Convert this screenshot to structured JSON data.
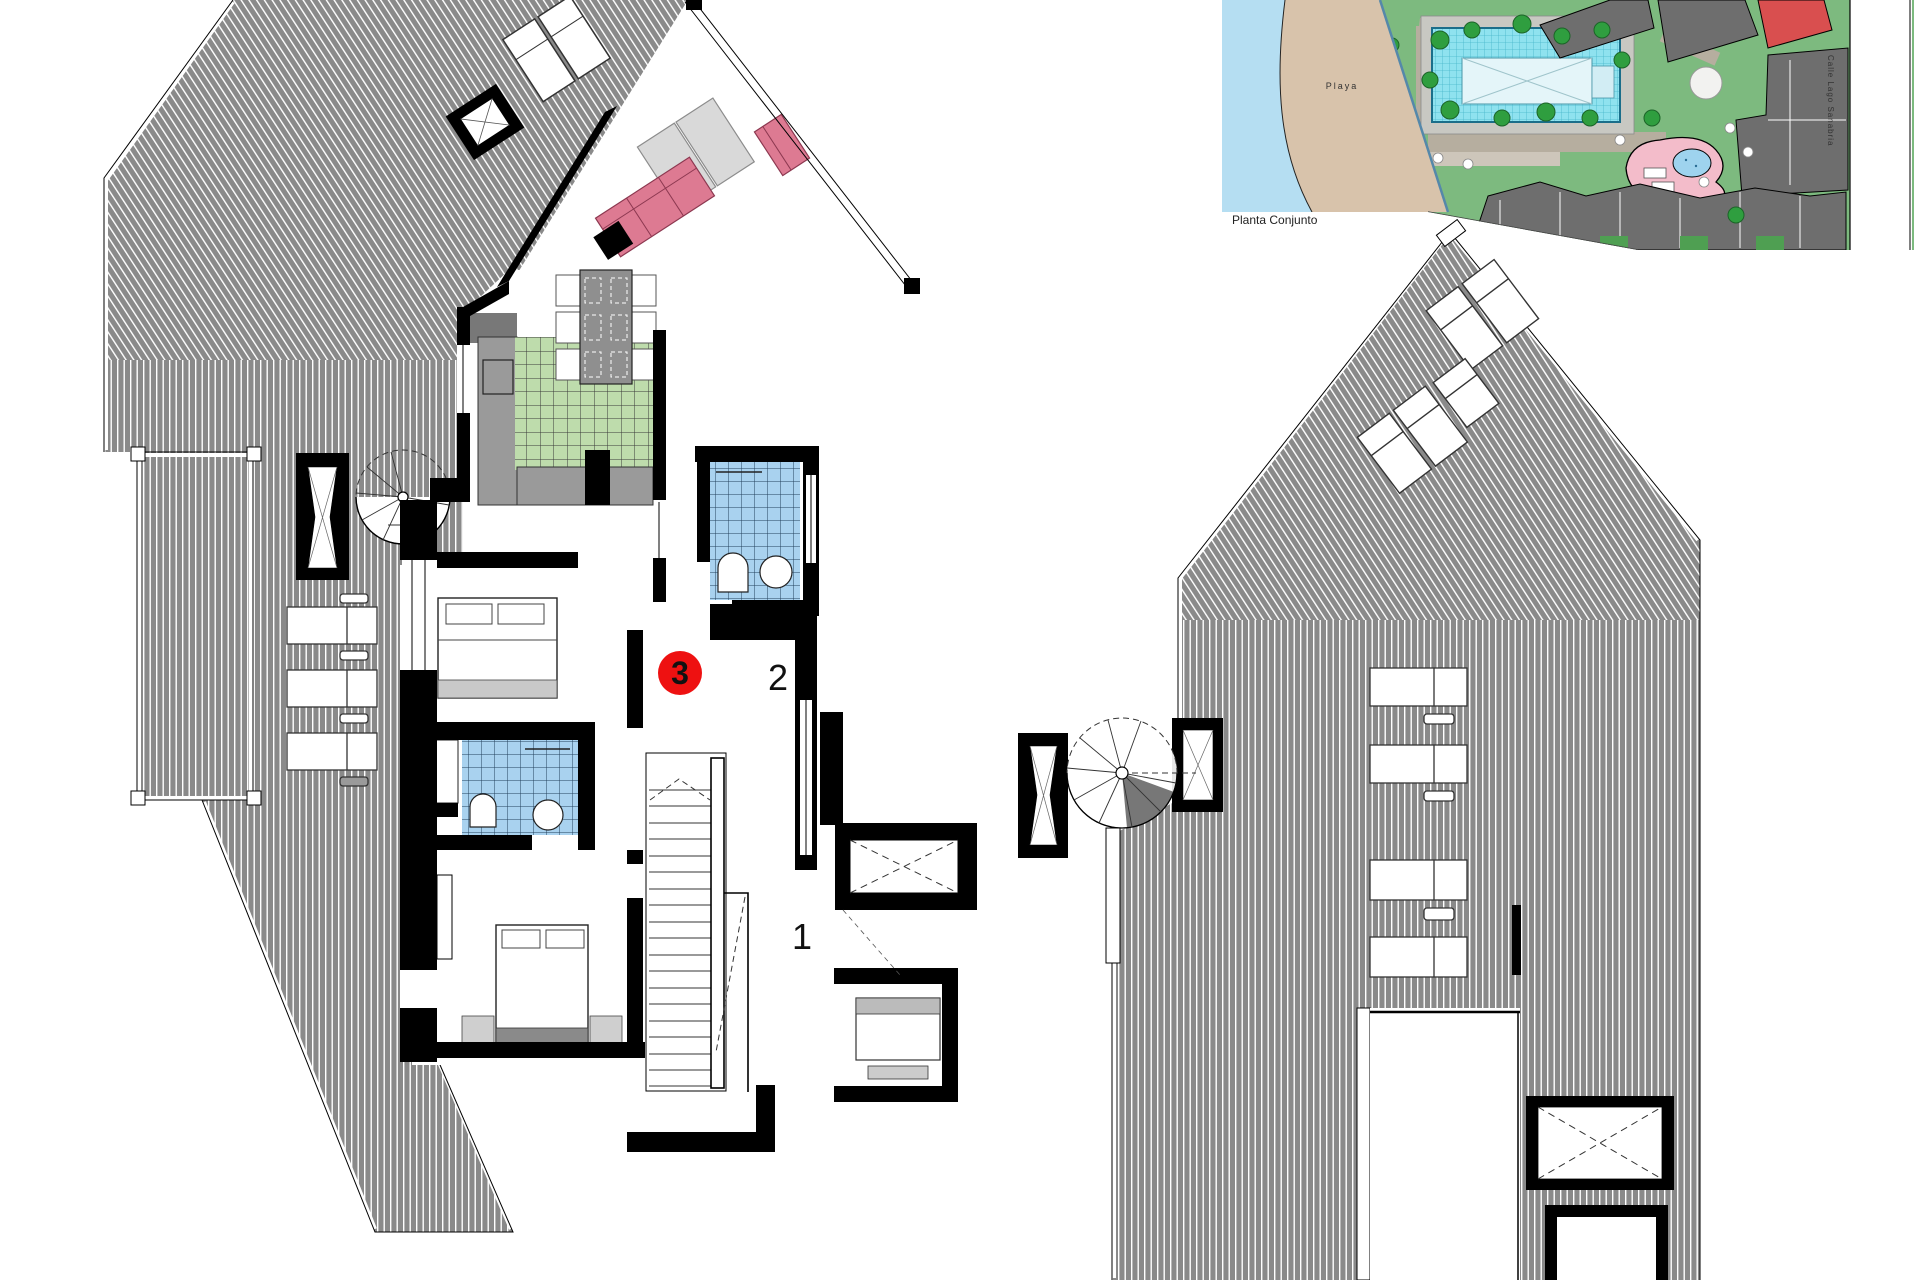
{
  "document": {
    "type": "architectural-floor-plan",
    "background": "#ffffff"
  },
  "floorplan": {
    "unit_badge": {
      "number": "3",
      "color": "#ee1111"
    },
    "room_labels": {
      "room2": "2",
      "room1": "1"
    }
  },
  "site_plan": {
    "caption": "Planta Conjunto",
    "beach_label": "Playa",
    "street_label": "Calle Lago Sanabria"
  },
  "colors": {
    "terrace_hatch": "#8a8a8a",
    "wall": "#000000",
    "sofa_pink": "#dd7a92",
    "kitchen_tile": "#bedcac",
    "bath_tile": "#a9d2ef",
    "sea": "#b5def2",
    "sand": "#d8c3ab",
    "lawn": "#7dba7f",
    "pool": "#8fe2ef",
    "building": "#6e6e6e",
    "highlight_building": "#d94f4f",
    "kids_pool_area": "#f3bcca"
  }
}
